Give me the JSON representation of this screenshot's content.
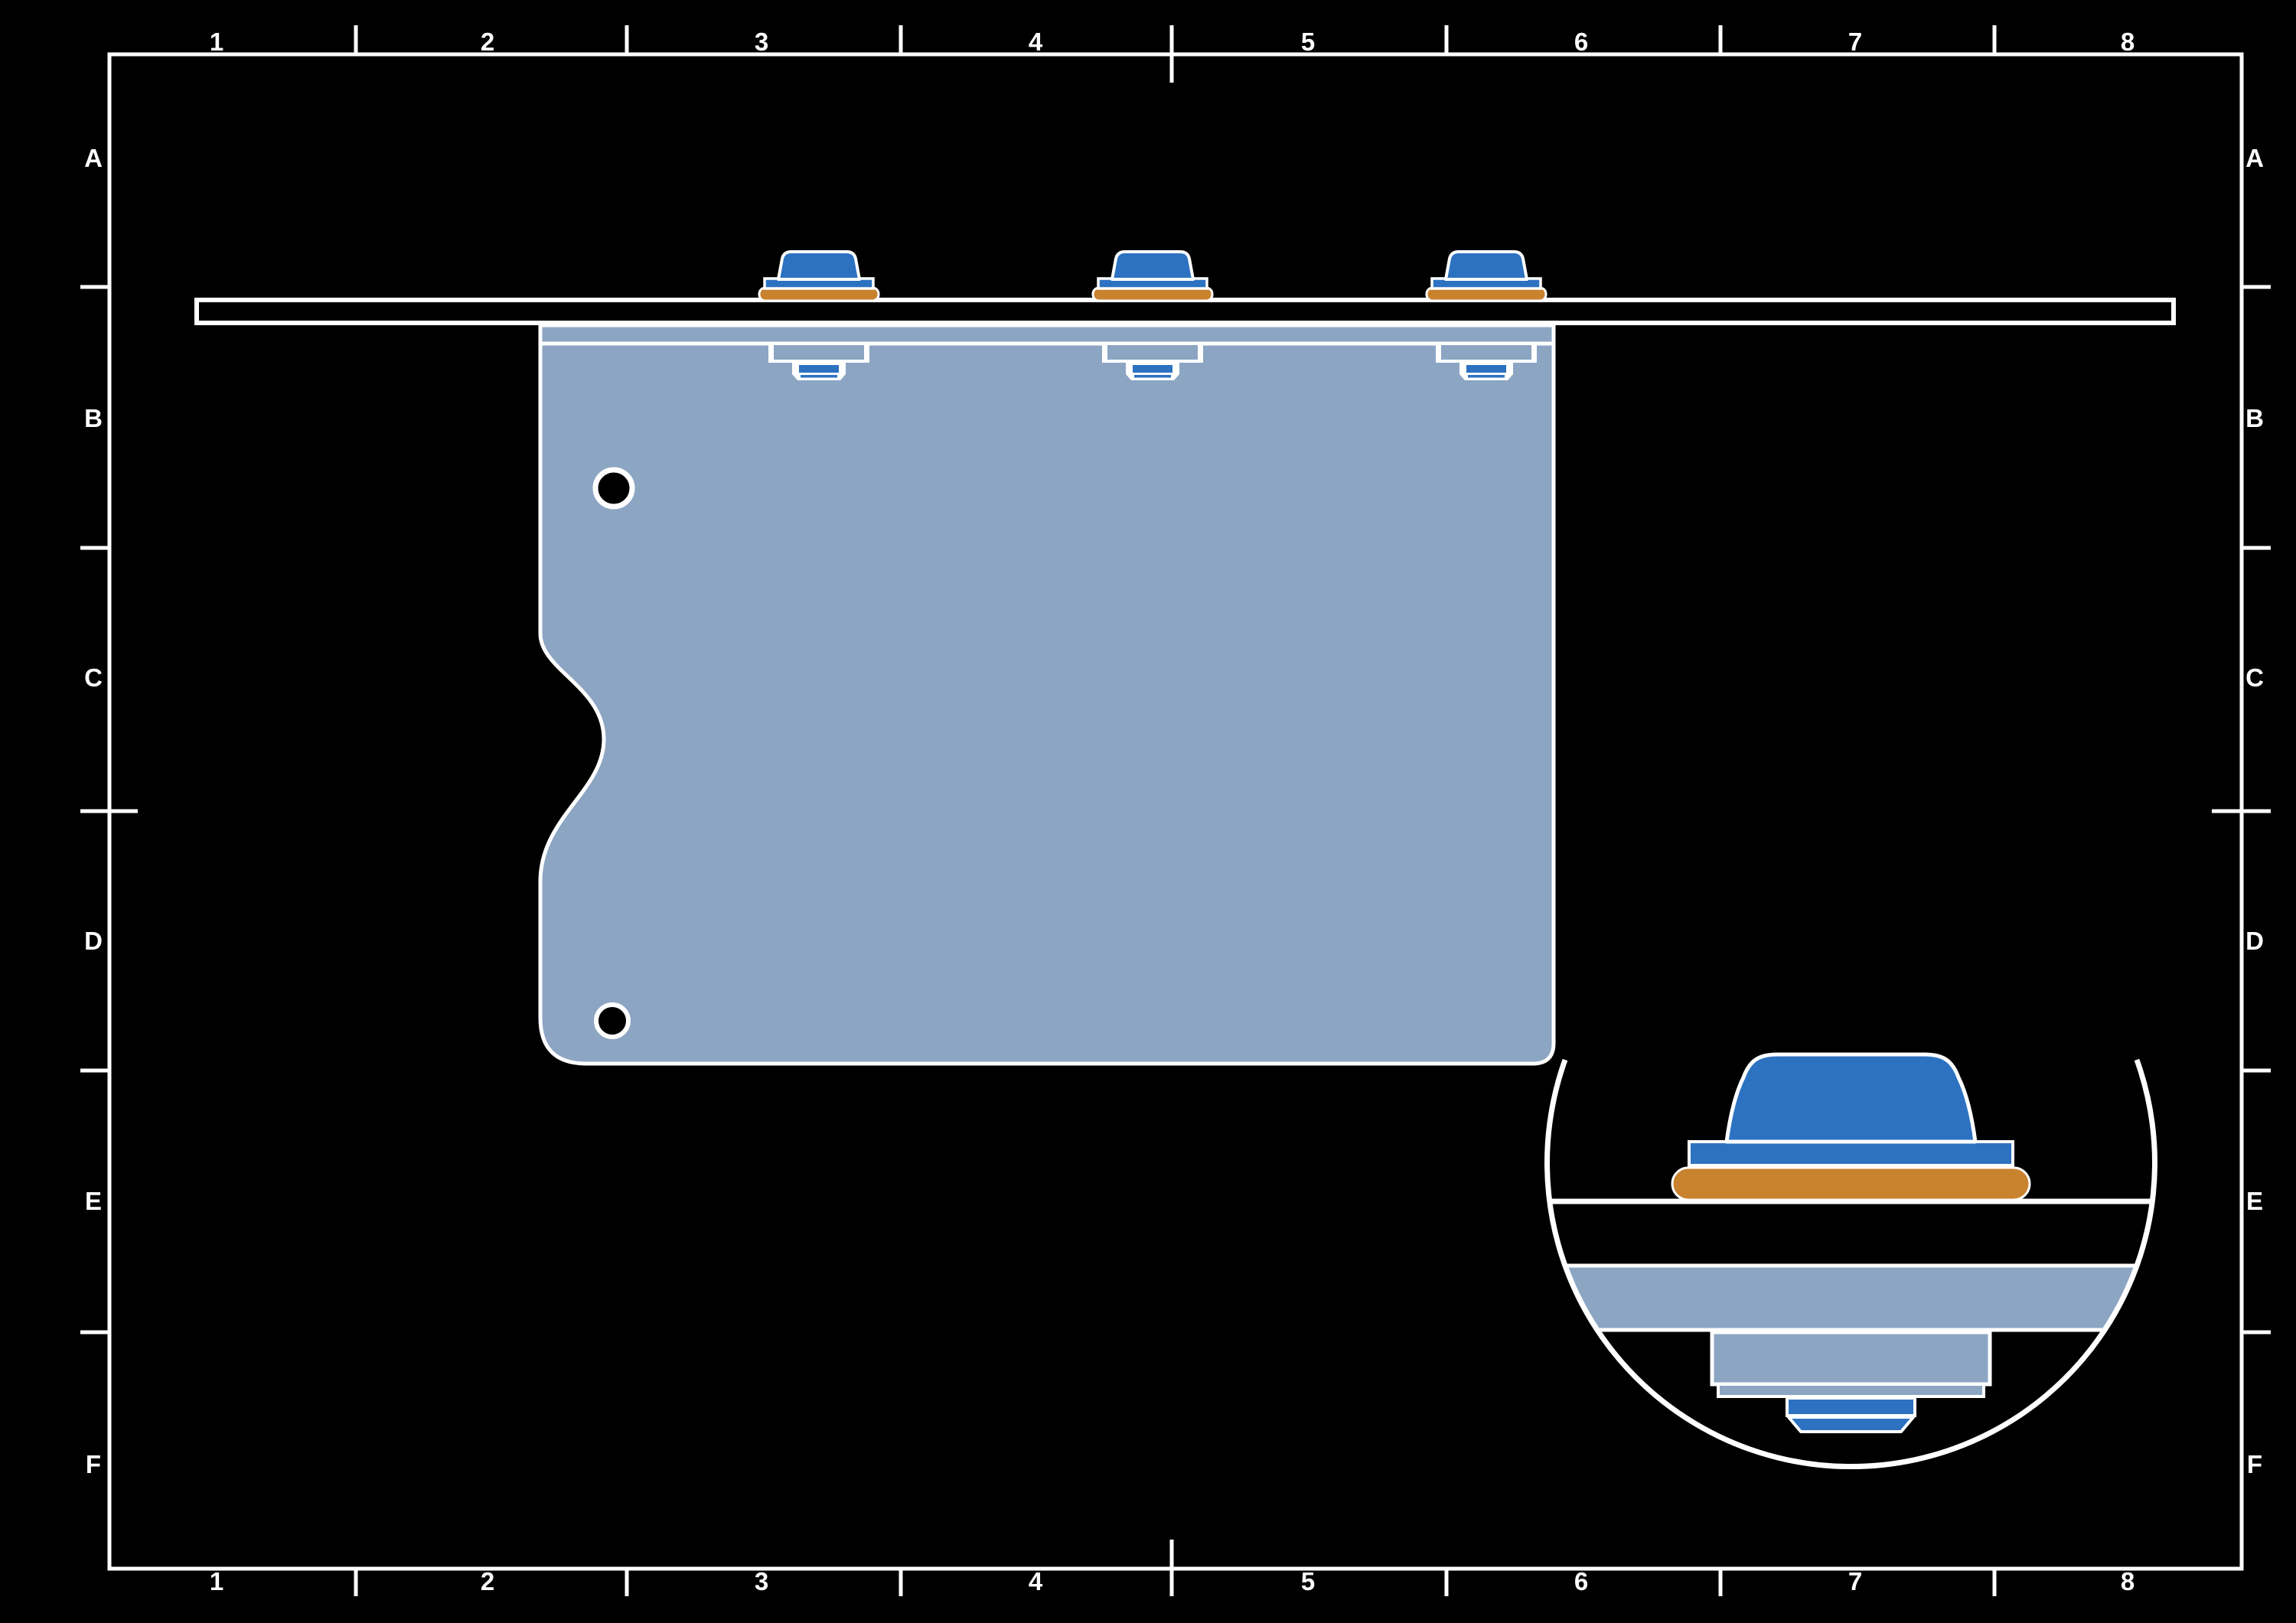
{
  "sheet": {
    "background": "#000000",
    "line_color": "#FFFFFF",
    "grid": {
      "columns": [
        "1",
        "2",
        "3",
        "4",
        "5",
        "6",
        "7",
        "8"
      ],
      "rows": [
        "A",
        "B",
        "C",
        "D",
        "E",
        "F"
      ]
    }
  },
  "colors": {
    "fastener_blue": "#2D72C1",
    "washer_orange": "#C9822E",
    "panel_blue_gray": "#8CA5C3"
  },
  "views": {
    "main": {
      "fastener_count": 3,
      "hole_count": 2
    },
    "detail": {
      "magnified_fastener_count": 1
    }
  }
}
